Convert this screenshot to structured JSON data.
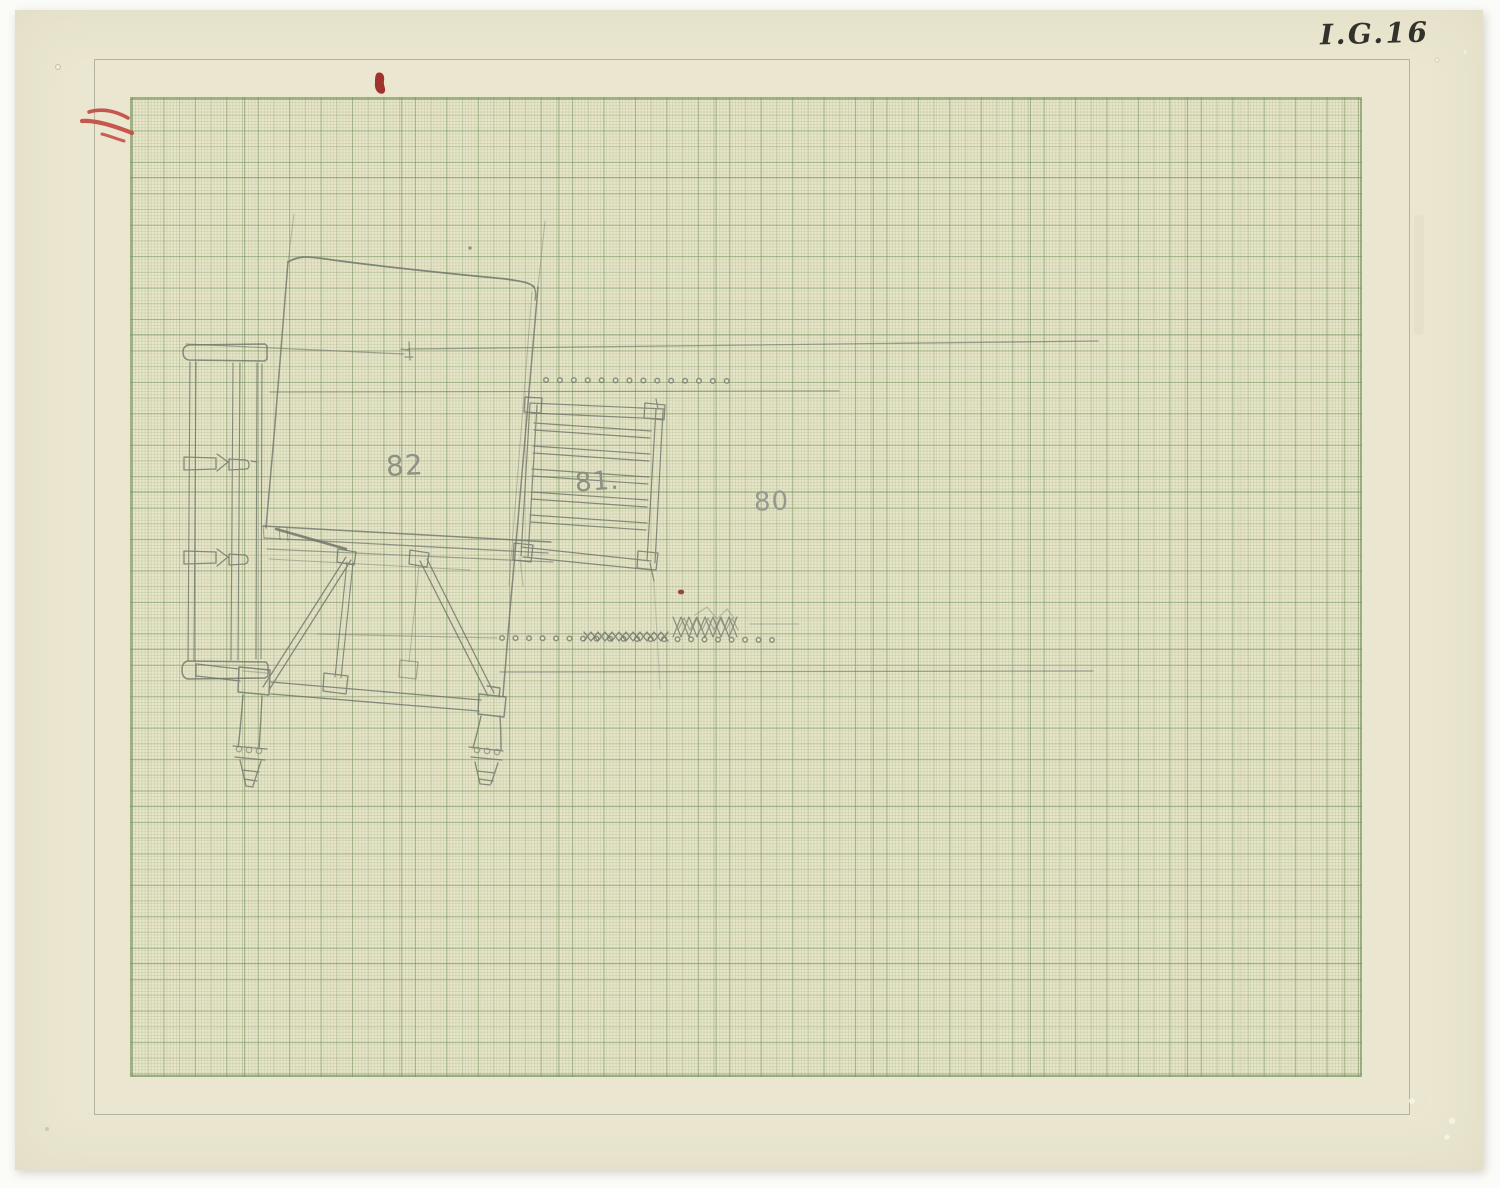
{
  "document": {
    "catalog_number": "I.G.16"
  },
  "figures": [
    {
      "label": "82"
    },
    {
      "label": "81."
    },
    {
      "label": "80"
    }
  ],
  "colors": {
    "paper": "#eae6d0",
    "grid_green": "#7c9860",
    "pencil": "#70746a",
    "red_crayon": "#c2473e",
    "red_ink": "#9c2a24"
  }
}
